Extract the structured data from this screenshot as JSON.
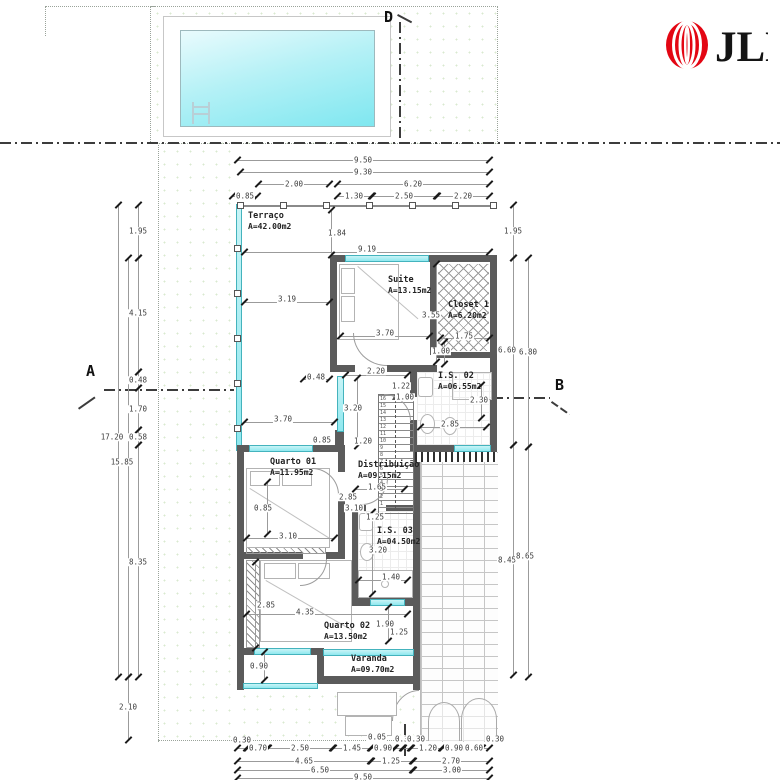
{
  "brand": {
    "name": "JLL",
    "color": "#e30613"
  },
  "section_markers": [
    {
      "label": "D",
      "x": 384,
      "y": 8
    },
    {
      "label": "A",
      "x": 86,
      "y": 362
    },
    {
      "label": "B",
      "x": 555,
      "y": 376
    }
  ],
  "rooms": [
    {
      "name": "Terraço",
      "area": "A=42.00m2",
      "x": 248,
      "y": 212
    },
    {
      "name": "Suite",
      "area": "A=13.15m2",
      "x": 388,
      "y": 276
    },
    {
      "name": "Closet 1",
      "area": "A=6.20m2",
      "x": 448,
      "y": 301
    },
    {
      "name": "I.S. 02",
      "area": "A=06.55m2",
      "x": 438,
      "y": 372
    },
    {
      "name": "Quarto 01",
      "area": "A=11.95m2",
      "x": 270,
      "y": 458
    },
    {
      "name": "Distribuição",
      "area": "A=09.15m2",
      "x": 358,
      "y": 461
    },
    {
      "name": "I.S. 03",
      "area": "A=04.50m2",
      "x": 377,
      "y": 527
    },
    {
      "name": "Quarto 02",
      "area": "A=13.50m2",
      "x": 324,
      "y": 622
    },
    {
      "name": "Varanda",
      "area": "A=09.70m2",
      "x": 351,
      "y": 655
    }
  ],
  "stairs": {
    "tread_numbers": [
      16,
      15,
      14,
      13,
      12,
      11,
      10,
      9,
      8,
      7,
      6,
      5,
      4,
      3,
      2,
      1
    ]
  },
  "dim_labels": [
    {
      "t": "9.50",
      "x": 363,
      "y": 160
    },
    {
      "t": "9.30",
      "x": 363,
      "y": 172
    },
    {
      "t": "2.00",
      "x": 294,
      "y": 184
    },
    {
      "t": "6.20",
      "x": 413,
      "y": 184
    },
    {
      "t": "0.85",
      "x": 245,
      "y": 196
    },
    {
      "t": "1.30",
      "x": 354,
      "y": 196
    },
    {
      "t": "2.50",
      "x": 404,
      "y": 196
    },
    {
      "t": "2.20",
      "x": 463,
      "y": 196
    },
    {
      "t": "0.30",
      "x": 242,
      "y": 740
    },
    {
      "t": "0.70",
      "x": 258,
      "y": 748
    },
    {
      "t": "2.50",
      "x": 300,
      "y": 748
    },
    {
      "t": "1.45",
      "x": 352,
      "y": 748
    },
    {
      "t": "0.05",
      "x": 377,
      "y": 737
    },
    {
      "t": "0.90",
      "x": 383,
      "y": 748
    },
    {
      "t": "0.30",
      "x": 404,
      "y": 739
    },
    {
      "t": "0.30",
      "x": 416,
      "y": 739
    },
    {
      "t": "1.20",
      "x": 428,
      "y": 748
    },
    {
      "t": "0.90",
      "x": 454,
      "y": 748
    },
    {
      "t": "0.60",
      "x": 474,
      "y": 748
    },
    {
      "t": "0.30",
      "x": 495,
      "y": 739
    },
    {
      "t": "4.65",
      "x": 304,
      "y": 761
    },
    {
      "t": "1.25",
      "x": 391,
      "y": 761
    },
    {
      "t": "2.70",
      "x": 451,
      "y": 761
    },
    {
      "t": "6.50",
      "x": 320,
      "y": 770
    },
    {
      "t": "3.00",
      "x": 452,
      "y": 770
    },
    {
      "t": "9.50",
      "x": 363,
      "y": 777
    },
    {
      "t": "1.95",
      "x": 138,
      "y": 231
    },
    {
      "t": "4.15",
      "x": 138,
      "y": 313
    },
    {
      "t": "0.48",
      "x": 138,
      "y": 380
    },
    {
      "t": "1.70",
      "x": 138,
      "y": 409
    },
    {
      "t": "0.58",
      "x": 138,
      "y": 437
    },
    {
      "t": "17.20",
      "x": 112,
      "y": 437
    },
    {
      "t": "15.85",
      "x": 122,
      "y": 462
    },
    {
      "t": "8.35",
      "x": 138,
      "y": 562
    },
    {
      "t": "2.10",
      "x": 128,
      "y": 707
    },
    {
      "t": "1.95",
      "x": 513,
      "y": 231
    },
    {
      "t": "6.60",
      "x": 507,
      "y": 350
    },
    {
      "t": "6.80",
      "x": 528,
      "y": 352
    },
    {
      "t": "8.45",
      "x": 507,
      "y": 560
    },
    {
      "t": "8.65",
      "x": 525,
      "y": 556
    },
    {
      "t": "1.84",
      "x": 337,
      "y": 233
    },
    {
      "t": "9.19",
      "x": 367,
      "y": 249
    },
    {
      "t": "3.19",
      "x": 287,
      "y": 299
    },
    {
      "t": "3.55",
      "x": 431,
      "y": 315
    },
    {
      "t": "3.70",
      "x": 385,
      "y": 333
    },
    {
      "t": "1.75",
      "x": 464,
      "y": 336
    },
    {
      "t": "1.00",
      "x": 441,
      "y": 351
    },
    {
      "t": "2.20",
      "x": 376,
      "y": 371
    },
    {
      "t": "0.48",
      "x": 316,
      "y": 377
    },
    {
      "t": "1.22",
      "x": 401,
      "y": 386
    },
    {
      "t": "1.00",
      "x": 405,
      "y": 397
    },
    {
      "t": "2.30",
      "x": 479,
      "y": 400
    },
    {
      "t": "3.20",
      "x": 353,
      "y": 408
    },
    {
      "t": "3.70",
      "x": 283,
      "y": 419
    },
    {
      "t": "2.85",
      "x": 450,
      "y": 424
    },
    {
      "t": "0.85",
      "x": 322,
      "y": 440
    },
    {
      "t": "1.20",
      "x": 363,
      "y": 441
    },
    {
      "t": "1.65",
      "x": 377,
      "y": 487
    },
    {
      "t": "2.85",
      "x": 348,
      "y": 497
    },
    {
      "t": "3.10",
      "x": 354,
      "y": 508
    },
    {
      "t": "1.25",
      "x": 375,
      "y": 517
    },
    {
      "t": "0.85",
      "x": 263,
      "y": 508
    },
    {
      "t": "3.10",
      "x": 288,
      "y": 536
    },
    {
      "t": "3.20",
      "x": 378,
      "y": 550
    },
    {
      "t": "1.40",
      "x": 391,
      "y": 577
    },
    {
      "t": "2.85",
      "x": 266,
      "y": 605
    },
    {
      "t": "4.35",
      "x": 305,
      "y": 612
    },
    {
      "t": "1.90",
      "x": 385,
      "y": 624
    },
    {
      "t": "1.25",
      "x": 399,
      "y": 632
    },
    {
      "t": "0.90",
      "x": 259,
      "y": 666
    }
  ],
  "dim_lines": [
    [
      237,
      160,
      253,
      "h"
    ],
    [
      240,
      172,
      250,
      "h"
    ],
    [
      258,
      184,
      72,
      "h"
    ],
    [
      337,
      184,
      153,
      "h"
    ],
    [
      232,
      196,
      26,
      "h"
    ],
    [
      337,
      196,
      35,
      "h"
    ],
    [
      372,
      196,
      65,
      "h"
    ],
    [
      437,
      196,
      53,
      "h"
    ],
    [
      237,
      748,
      10,
      "h"
    ],
    [
      247,
      748,
      21,
      "h"
    ],
    [
      268,
      748,
      65,
      "h"
    ],
    [
      333,
      748,
      38,
      "h"
    ],
    [
      371,
      748,
      24,
      "h"
    ],
    [
      395,
      748,
      8,
      "h"
    ],
    [
      403,
      748,
      8,
      "h"
    ],
    [
      411,
      748,
      31,
      "h"
    ],
    [
      442,
      748,
      24,
      "h"
    ],
    [
      466,
      748,
      16,
      "h"
    ],
    [
      482,
      748,
      8,
      "h"
    ],
    [
      237,
      761,
      134,
      "h"
    ],
    [
      371,
      761,
      42,
      "h"
    ],
    [
      413,
      761,
      77,
      "h"
    ],
    [
      237,
      770,
      176,
      "h"
    ],
    [
      413,
      770,
      77,
      "h"
    ],
    [
      237,
      778,
      253,
      "h"
    ],
    [
      118,
      205,
      472,
      "v"
    ],
    [
      128,
      258,
      419,
      "v"
    ],
    [
      128,
      677,
      63,
      "v"
    ],
    [
      138,
      205,
      53,
      "v"
    ],
    [
      138,
      258,
      114,
      "v"
    ],
    [
      138,
      372,
      16,
      "v"
    ],
    [
      138,
      388,
      42,
      "v"
    ],
    [
      138,
      430,
      15,
      "v"
    ],
    [
      138,
      445,
      232,
      "v"
    ],
    [
      513,
      205,
      53,
      "v"
    ],
    [
      513,
      258,
      187,
      "v"
    ],
    [
      513,
      445,
      230,
      "v"
    ],
    [
      528,
      258,
      189,
      "v"
    ],
    [
      528,
      447,
      230,
      "v"
    ],
    [
      244,
      252,
      246,
      "h"
    ],
    [
      331,
      210,
      45,
      "v"
    ],
    [
      244,
      302,
      86,
      "h"
    ],
    [
      340,
      336,
      90,
      "h"
    ],
    [
      436,
      264,
      98,
      "v"
    ],
    [
      440,
      338,
      50,
      "h"
    ],
    [
      444,
      342,
      22,
      "v"
    ],
    [
      345,
      375,
      63,
      "h"
    ],
    [
      303,
      379,
      27,
      "h"
    ],
    [
      357,
      378,
      68,
      "v"
    ],
    [
      244,
      422,
      91,
      "h"
    ],
    [
      420,
      427,
      67,
      "h"
    ],
    [
      481,
      385,
      33,
      "v"
    ],
    [
      355,
      489,
      50,
      "h"
    ],
    [
      267,
      482,
      52,
      "v"
    ],
    [
      246,
      538,
      89,
      "h"
    ],
    [
      372,
      512,
      82,
      "v"
    ],
    [
      358,
      580,
      50,
      "h"
    ],
    [
      255,
      562,
      86,
      "v"
    ],
    [
      246,
      614,
      162,
      "h"
    ],
    [
      388,
      607,
      34,
      "v"
    ],
    [
      264,
      652,
      28,
      "v"
    ]
  ]
}
